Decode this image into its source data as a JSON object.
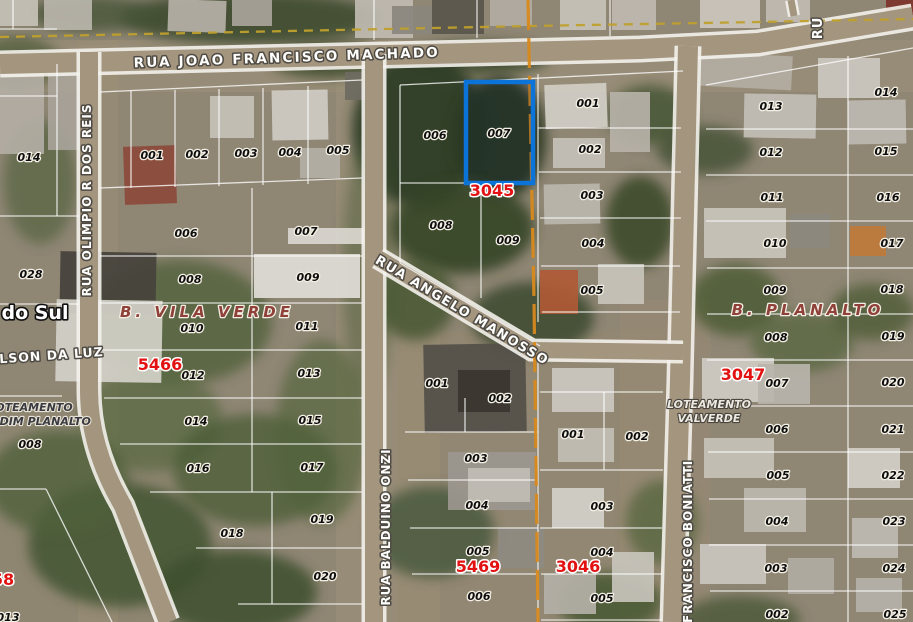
{
  "map": {
    "city_label": {
      "text": "s do Sul",
      "x": 26,
      "y": 319
    },
    "streets": [
      {
        "text": "RUA JOAO FRANCISCO MACHADO",
        "x": 287,
        "y": 62,
        "rotate": -2,
        "size": 13.5,
        "spacing": 2.2
      },
      {
        "text": "RUA OLIMPIO R DOS REIS",
        "x": 91,
        "y": 200,
        "rotate": -90,
        "size": 12,
        "spacing": 1
      },
      {
        "text": "RUA ANGELO MANOSSO",
        "x": 460,
        "y": 314,
        "rotate": 31,
        "size": 13,
        "spacing": 1.5
      },
      {
        "text": "RUA BALDUINO ONZI",
        "x": 390,
        "y": 527,
        "rotate": -90,
        "size": 12,
        "spacing": 1
      },
      {
        "text": "R. FRANCISCO BONIATTI",
        "x": 692,
        "y": 552,
        "rotate": -90,
        "size": 12,
        "spacing": 1
      },
      {
        "text": "RU",
        "x": 822,
        "y": 28,
        "rotate": -90,
        "size": 13,
        "spacing": 1
      },
      {
        "text": "OLSON DA LUZ",
        "x": 46,
        "y": 360,
        "rotate": -4,
        "size": 12.5,
        "spacing": 1
      }
    ],
    "districts": [
      {
        "text": "B. VILA VERDE",
        "x": 207,
        "y": 317
      },
      {
        "text": "B. PLANALTO",
        "x": 808,
        "y": 315
      }
    ],
    "subdivisions": [
      {
        "text": "OTEAMENTO",
        "x": 34,
        "y": 411,
        "tone": "dark"
      },
      {
        "text": "RDIM PLANALTO",
        "x": 41,
        "y": 425,
        "tone": "dark"
      },
      {
        "text": "LOTEAMENTO",
        "x": 709,
        "y": 408,
        "tone": "light"
      },
      {
        "text": "VALVERDE",
        "x": 709,
        "y": 422,
        "tone": "light"
      }
    ],
    "block_numbers": [
      {
        "text": "3045",
        "x": 492,
        "y": 196
      },
      {
        "text": "5466",
        "x": 160,
        "y": 370
      },
      {
        "text": "5469",
        "x": 478,
        "y": 572
      },
      {
        "text": "3046",
        "x": 578,
        "y": 572
      },
      {
        "text": "3047",
        "x": 743,
        "y": 380
      },
      {
        "text": "58",
        "x": 3,
        "y": 585
      }
    ],
    "lot_numbers": [
      {
        "text": "014",
        "x": 29,
        "y": 161
      },
      {
        "text": "028",
        "x": 31,
        "y": 278
      },
      {
        "text": "008",
        "x": 30,
        "y": 448
      },
      {
        "text": "013",
        "x": 8,
        "y": 621
      },
      {
        "text": "001",
        "x": 152,
        "y": 159
      },
      {
        "text": "002",
        "x": 197,
        "y": 158
      },
      {
        "text": "003",
        "x": 246,
        "y": 157
      },
      {
        "text": "004",
        "x": 290,
        "y": 156
      },
      {
        "text": "005",
        "x": 338,
        "y": 154
      },
      {
        "text": "006",
        "x": 186,
        "y": 237
      },
      {
        "text": "007",
        "x": 306,
        "y": 235
      },
      {
        "text": "008",
        "x": 190,
        "y": 283
      },
      {
        "text": "009",
        "x": 308,
        "y": 281
      },
      {
        "text": "010",
        "x": 192,
        "y": 332
      },
      {
        "text": "011",
        "x": 307,
        "y": 330
      },
      {
        "text": "012",
        "x": 193,
        "y": 379
      },
      {
        "text": "013",
        "x": 309,
        "y": 377
      },
      {
        "text": "014",
        "x": 196,
        "y": 425
      },
      {
        "text": "015",
        "x": 310,
        "y": 424
      },
      {
        "text": "016",
        "x": 198,
        "y": 472
      },
      {
        "text": "017",
        "x": 312,
        "y": 471
      },
      {
        "text": "018",
        "x": 232,
        "y": 537
      },
      {
        "text": "019",
        "x": 322,
        "y": 523
      },
      {
        "text": "020",
        "x": 325,
        "y": 580
      },
      {
        "text": "006",
        "x": 435,
        "y": 139
      },
      {
        "text": "007",
        "x": 499,
        "y": 137
      },
      {
        "text": "008",
        "x": 441,
        "y": 229
      },
      {
        "text": "009",
        "x": 508,
        "y": 244
      },
      {
        "text": "001",
        "x": 588,
        "y": 107
      },
      {
        "text": "002",
        "x": 590,
        "y": 153
      },
      {
        "text": "003",
        "x": 592,
        "y": 199
      },
      {
        "text": "004",
        "x": 593,
        "y": 247
      },
      {
        "text": "005",
        "x": 592,
        "y": 294
      },
      {
        "text": "001",
        "x": 437,
        "y": 387
      },
      {
        "text": "002",
        "x": 500,
        "y": 402
      },
      {
        "text": "003",
        "x": 476,
        "y": 462
      },
      {
        "text": "004",
        "x": 477,
        "y": 509
      },
      {
        "text": "005",
        "x": 478,
        "y": 555
      },
      {
        "text": "006",
        "x": 479,
        "y": 600
      },
      {
        "text": "001",
        "x": 573,
        "y": 438
      },
      {
        "text": "002",
        "x": 637,
        "y": 440
      },
      {
        "text": "003",
        "x": 602,
        "y": 510
      },
      {
        "text": "004",
        "x": 602,
        "y": 556
      },
      {
        "text": "005",
        "x": 602,
        "y": 602
      },
      {
        "text": "013",
        "x": 771,
        "y": 110
      },
      {
        "text": "012",
        "x": 771,
        "y": 156
      },
      {
        "text": "011",
        "x": 772,
        "y": 201
      },
      {
        "text": "010",
        "x": 775,
        "y": 247
      },
      {
        "text": "009",
        "x": 775,
        "y": 294
      },
      {
        "text": "008",
        "x": 776,
        "y": 341
      },
      {
        "text": "007",
        "x": 777,
        "y": 387
      },
      {
        "text": "006",
        "x": 777,
        "y": 433
      },
      {
        "text": "005",
        "x": 778,
        "y": 479
      },
      {
        "text": "004",
        "x": 777,
        "y": 525
      },
      {
        "text": "003",
        "x": 776,
        "y": 572
      },
      {
        "text": "002",
        "x": 777,
        "y": 618
      },
      {
        "text": "014",
        "x": 886,
        "y": 96
      },
      {
        "text": "015",
        "x": 886,
        "y": 155
      },
      {
        "text": "016",
        "x": 888,
        "y": 201
      },
      {
        "text": "017",
        "x": 892,
        "y": 247
      },
      {
        "text": "018",
        "x": 892,
        "y": 293
      },
      {
        "text": "019",
        "x": 893,
        "y": 340
      },
      {
        "text": "020",
        "x": 893,
        "y": 386
      },
      {
        "text": "021",
        "x": 893,
        "y": 433
      },
      {
        "text": "022",
        "x": 893,
        "y": 479
      },
      {
        "text": "023",
        "x": 894,
        "y": 525
      },
      {
        "text": "024",
        "x": 894,
        "y": 572
      },
      {
        "text": "025",
        "x": 895,
        "y": 618
      }
    ],
    "highlight": {
      "lot": "007",
      "x": 466,
      "y": 82,
      "width": 67,
      "height": 101
    },
    "colors": {
      "lot_text": "#0d0d0d",
      "block_text": "#e31212",
      "district_text": "#8f4038",
      "street_text": "#fdfdfb",
      "street_halo": "#4f4b44",
      "subdiv_dark": "#3a3a40",
      "subdiv_light": "#ece9e2",
      "city_text": "#ffffff",
      "parcel_line": "#ffffff",
      "road_fill": "#a3957e",
      "road_edge": "#f4f2ec",
      "highlight_blue": "#0c73d8",
      "dashed_yellow": "#bfa02c",
      "dashed_orange": "#d8891c",
      "halo_light": "#f3efe4"
    }
  }
}
